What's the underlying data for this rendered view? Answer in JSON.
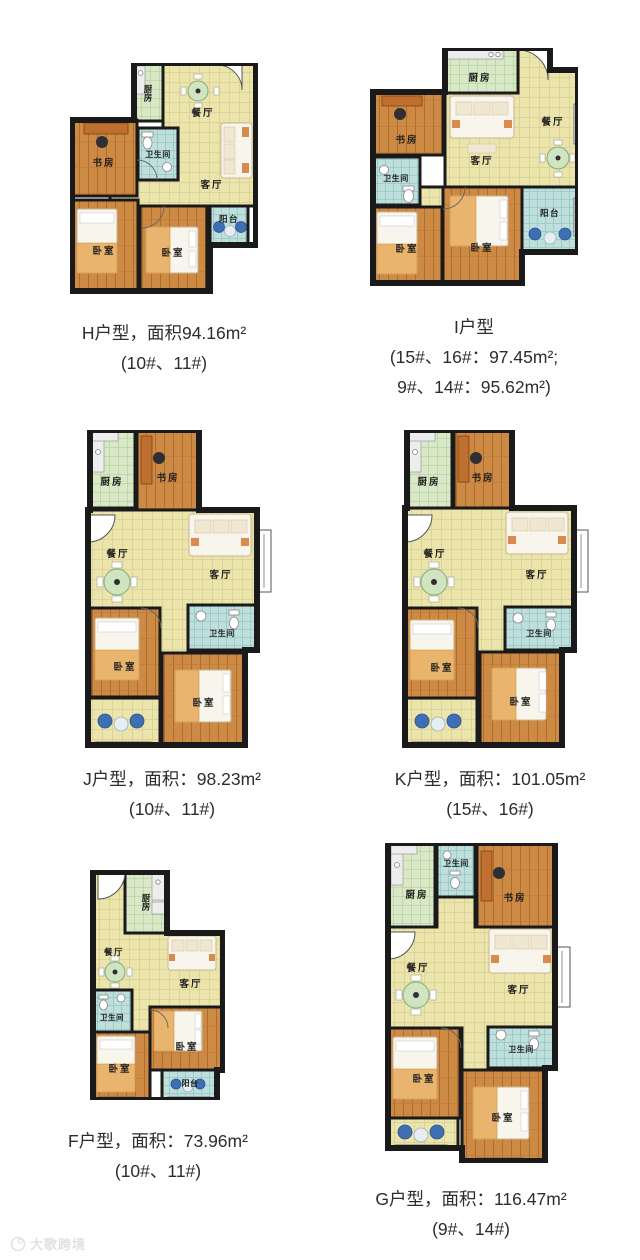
{
  "room_labels": {
    "kitchen": "厨房",
    "dining": "餐厅",
    "living": "客厅",
    "study": "书房",
    "bath": "卫生间",
    "bedroom": "卧室",
    "balcony": "阳台"
  },
  "plans": [
    {
      "id": "H",
      "caption": [
        "H户型，面积94.16m²",
        "(10#、11#)"
      ]
    },
    {
      "id": "I",
      "caption": [
        "I户型",
        "(15#、16#：97.45m²;",
        "9#、14#：95.62m²)"
      ]
    },
    {
      "id": "J",
      "caption": [
        "J户型，面积：98.23m²",
        "(10#、11#)"
      ]
    },
    {
      "id": "K",
      "caption": [
        "K户型，面积：101.05m²",
        "(15#、16#)"
      ]
    },
    {
      "id": "F",
      "caption": [
        "F户型，面积：73.96m²",
        "(10#、11#)"
      ]
    },
    {
      "id": "G",
      "caption": [
        "G户型，面积：116.47m²",
        "(9#、14#)"
      ]
    }
  ],
  "watermark": {
    "text": "大歌跨境"
  },
  "palette": {
    "wall": "#1a1a1a",
    "floor_tile_cream": "#ebe4ab",
    "kitchen_tile_green": "#d9e8c6",
    "bath_tile_cyan": "#bedfdc",
    "wood_floor": "#cd8a45",
    "furniture_orange": "#bf7030",
    "sofa_white": "#f8f5ec",
    "washer_blue": "#3f6fb3",
    "table_green": "#cfe5c0",
    "caption_text": "#2d2d2d"
  }
}
